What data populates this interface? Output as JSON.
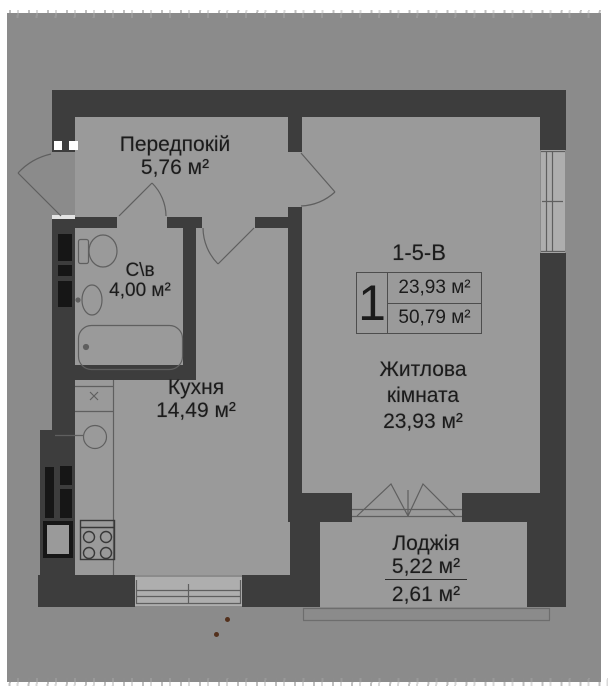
{
  "plan": {
    "code": "1-5-В",
    "summary": {
      "rooms": "1",
      "area_top": "23,93 м²",
      "area_bottom": "50,79 м²"
    },
    "hallway": {
      "name": "Передпокій",
      "area": "5,76 м²"
    },
    "bathroom": {
      "name": "С\\в",
      "area": "4,00 м²"
    },
    "kitchen": {
      "name": "Кухня",
      "area": "14,49 м²"
    },
    "living": {
      "name1": "Житлова",
      "name2": "кімната",
      "area": "23,93 м²"
    },
    "loggia": {
      "name": "Лоджія",
      "area_total": "5,22 м²",
      "area_half": "2,61 м²"
    }
  },
  "colors": {
    "background": "#8b8b8b",
    "wall": "#3d3d3d",
    "floor": "#9a9a9a",
    "window": "#aeaeae",
    "paper_edge": "#ffffff",
    "text": "#1b1b1b",
    "shaft": "#161616",
    "artifact_dot": "#53301c"
  }
}
